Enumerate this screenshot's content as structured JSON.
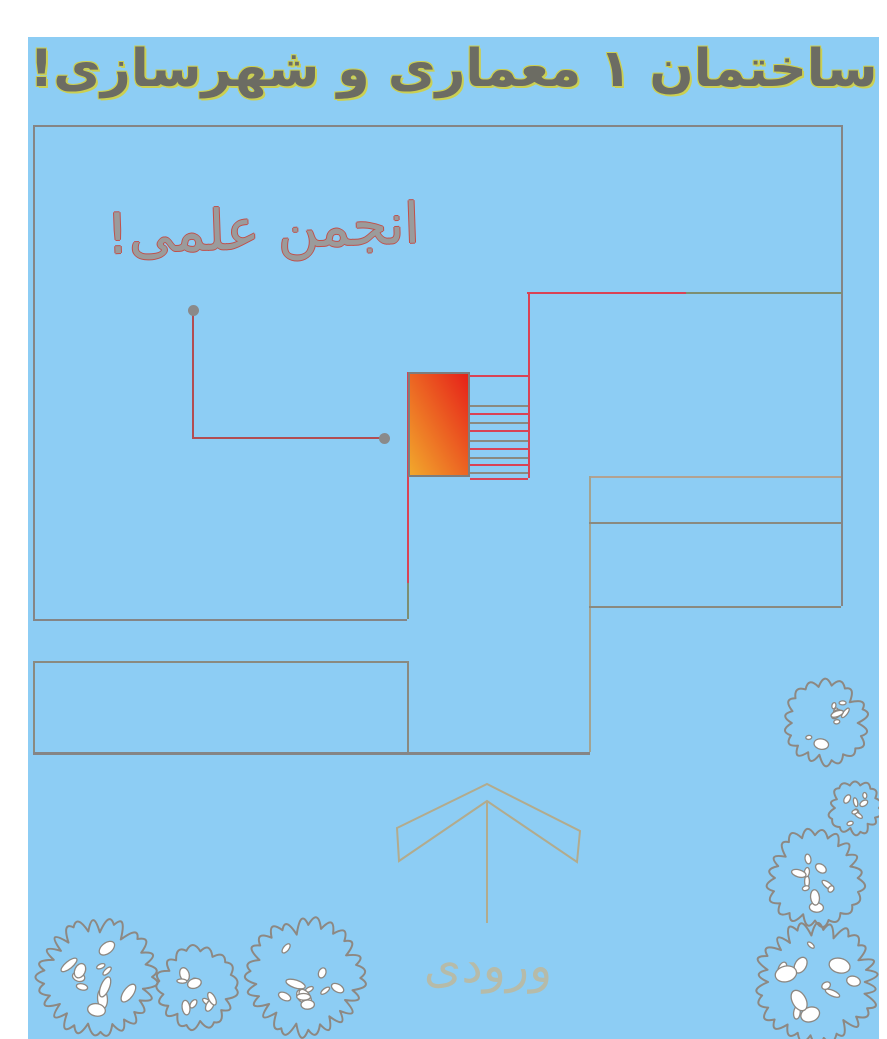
{
  "title": {
    "text": "ساختمان ۱ معماری و شهرسازی!"
  },
  "labels": {
    "association": "انجمن علمی!",
    "entrance": "ورودی"
  },
  "colors": {
    "page_margin": "#ffffff",
    "background": "#8dcdf4",
    "title_fill": "#6c6c63",
    "title_outline": "#cbcf52",
    "label_fill": "#9b9b9b",
    "label_outline": "#c0504a",
    "entrance_text": "#b6bba9",
    "arrow_tan": "#b2ab8d",
    "gray": "#858585",
    "gray2": "#8a8a80",
    "graytan": "#a3a391",
    "tan": "#b2a292",
    "greengray": "#7d8f72",
    "red": "#d94355",
    "leader_red": "#b24d52",
    "dot_gray": "#8a8a8a",
    "room_gradient_top_right": "#e62119",
    "room_gradient_bottom_left": "#f2a82c",
    "room_border": "#7d7d7d",
    "tree_stroke": "#8d8882",
    "tree_blob_fill": "#ffffff"
  },
  "plan": {
    "walls": [
      {
        "x": 5,
        "y": 88,
        "w": 808,
        "h": 2,
        "c": "gray"
      },
      {
        "x": 5,
        "y": 88,
        "w": 2,
        "h": 494,
        "c": "gray"
      },
      {
        "x": 5,
        "y": 582,
        "w": 374,
        "h": 2,
        "c": "gray"
      },
      {
        "x": 813,
        "y": 88,
        "w": 2,
        "h": 481,
        "c": "gray"
      },
      {
        "x": 499,
        "y": 255,
        "w": 160,
        "h": 2,
        "c": "red"
      },
      {
        "x": 658,
        "y": 255,
        "w": 156,
        "h": 2,
        "c": "greengray"
      },
      {
        "x": 500,
        "y": 255,
        "w": 2,
        "h": 186,
        "c": "red"
      },
      {
        "x": 442,
        "y": 338,
        "w": 58,
        "h": 2,
        "c": "red"
      },
      {
        "x": 379,
        "y": 335,
        "w": 2,
        "h": 211,
        "c": "red"
      },
      {
        "x": 379,
        "y": 546,
        "w": 2,
        "h": 36,
        "c": "greengray"
      },
      {
        "x": 561,
        "y": 439,
        "w": 252,
        "h": 2,
        "c": "tan"
      },
      {
        "x": 561,
        "y": 439,
        "w": 2,
        "h": 276,
        "c": "graytan"
      },
      {
        "x": 561,
        "y": 485,
        "w": 252,
        "h": 2,
        "c": "gray2"
      },
      {
        "x": 561,
        "y": 569,
        "w": 252,
        "h": 2,
        "c": "gray2"
      },
      {
        "x": 5,
        "y": 624,
        "w": 374,
        "h": 2,
        "c": "gray2"
      },
      {
        "x": 5,
        "y": 624,
        "w": 2,
        "h": 91,
        "c": "gray2"
      },
      {
        "x": 379,
        "y": 624,
        "w": 2,
        "h": 91,
        "c": "gray2"
      },
      {
        "x": 5,
        "y": 715,
        "w": 557,
        "h": 3,
        "c": "gray"
      }
    ],
    "stairs": {
      "x": 442,
      "width": 58,
      "treads": [
        {
          "y": 368,
          "c": "gray2"
        },
        {
          "y": 376,
          "c": "red"
        },
        {
          "y": 385,
          "c": "gray2"
        },
        {
          "y": 393,
          "c": "red"
        },
        {
          "y": 403,
          "c": "gray2"
        },
        {
          "y": 411,
          "c": "red"
        },
        {
          "y": 420,
          "c": "gray2"
        },
        {
          "y": 427,
          "c": "red"
        },
        {
          "y": 435,
          "c": "gray2"
        },
        {
          "y": 441,
          "c": "red"
        }
      ]
    },
    "room": {
      "x": 380,
      "y": 335,
      "width": 62,
      "height": 105
    },
    "leader": {
      "lines": [
        {
          "x": 164,
          "y": 276,
          "w": 2,
          "h": 124,
          "c": "leader_red"
        },
        {
          "x": 164,
          "y": 400,
          "w": 190,
          "h": 2,
          "c": "leader_red"
        }
      ],
      "dots": [
        {
          "cx": 165,
          "cy": 273
        },
        {
          "cx": 356,
          "cy": 401
        }
      ]
    },
    "arrow": {
      "chevron_points": "369,791 459,747 552,794 549,825 459,764 371,824",
      "stem": {
        "x1": 459,
        "y1": 764,
        "x2": 459,
        "y2": 886
      }
    },
    "trees": [
      {
        "cx": 69,
        "cy": 940,
        "r": 55
      },
      {
        "cx": 169,
        "cy": 951,
        "r": 38
      },
      {
        "cx": 277,
        "cy": 941,
        "r": 55
      },
      {
        "cx": 797,
        "cy": 686,
        "r": 40
      },
      {
        "cx": 827,
        "cy": 771,
        "r": 25
      },
      {
        "cx": 787,
        "cy": 841,
        "r": 45
      },
      {
        "cx": 789,
        "cy": 945,
        "r": 57
      }
    ]
  }
}
